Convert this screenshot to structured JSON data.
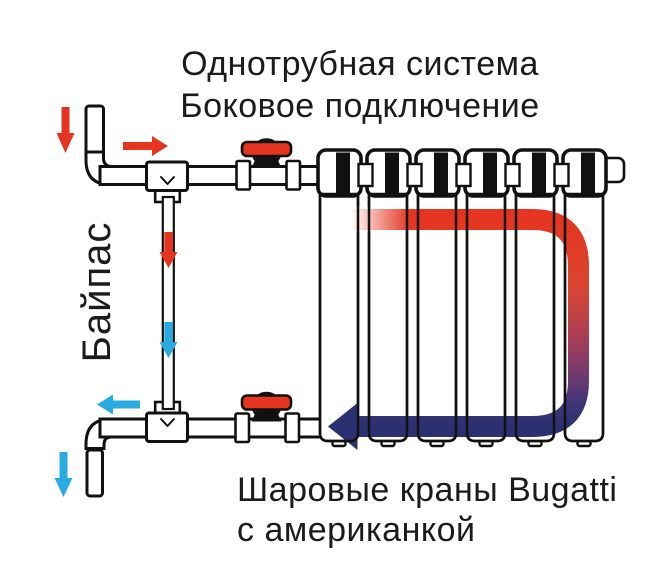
{
  "title": {
    "line1": "Однотрубная система",
    "line2": "Боковое подключение"
  },
  "bypass_label": "Байпас",
  "caption": {
    "line1": "Шаровые краны Bugatti",
    "line2": "с американкой"
  },
  "radiator": {
    "sections": 6
  },
  "valves": {
    "count": 2,
    "type_note": "ball-valve-with-red-lever"
  },
  "flow": {
    "supply_color": "#e5341f",
    "return_color": "#29abe2",
    "cooled_color": "#2b3070",
    "gradient": [
      "#e5341f",
      "#db4530",
      "#b03f51",
      "#7c3b6b",
      "#433677",
      "#2b3070"
    ]
  },
  "colors": {
    "outline": "#111111",
    "valve_red": "#e5341f",
    "hot_arrow": "#e5341f",
    "cold_arrow": "#29abe2",
    "navy": "#2b3070",
    "text": "#1b1b1b",
    "background": "#ffffff"
  }
}
